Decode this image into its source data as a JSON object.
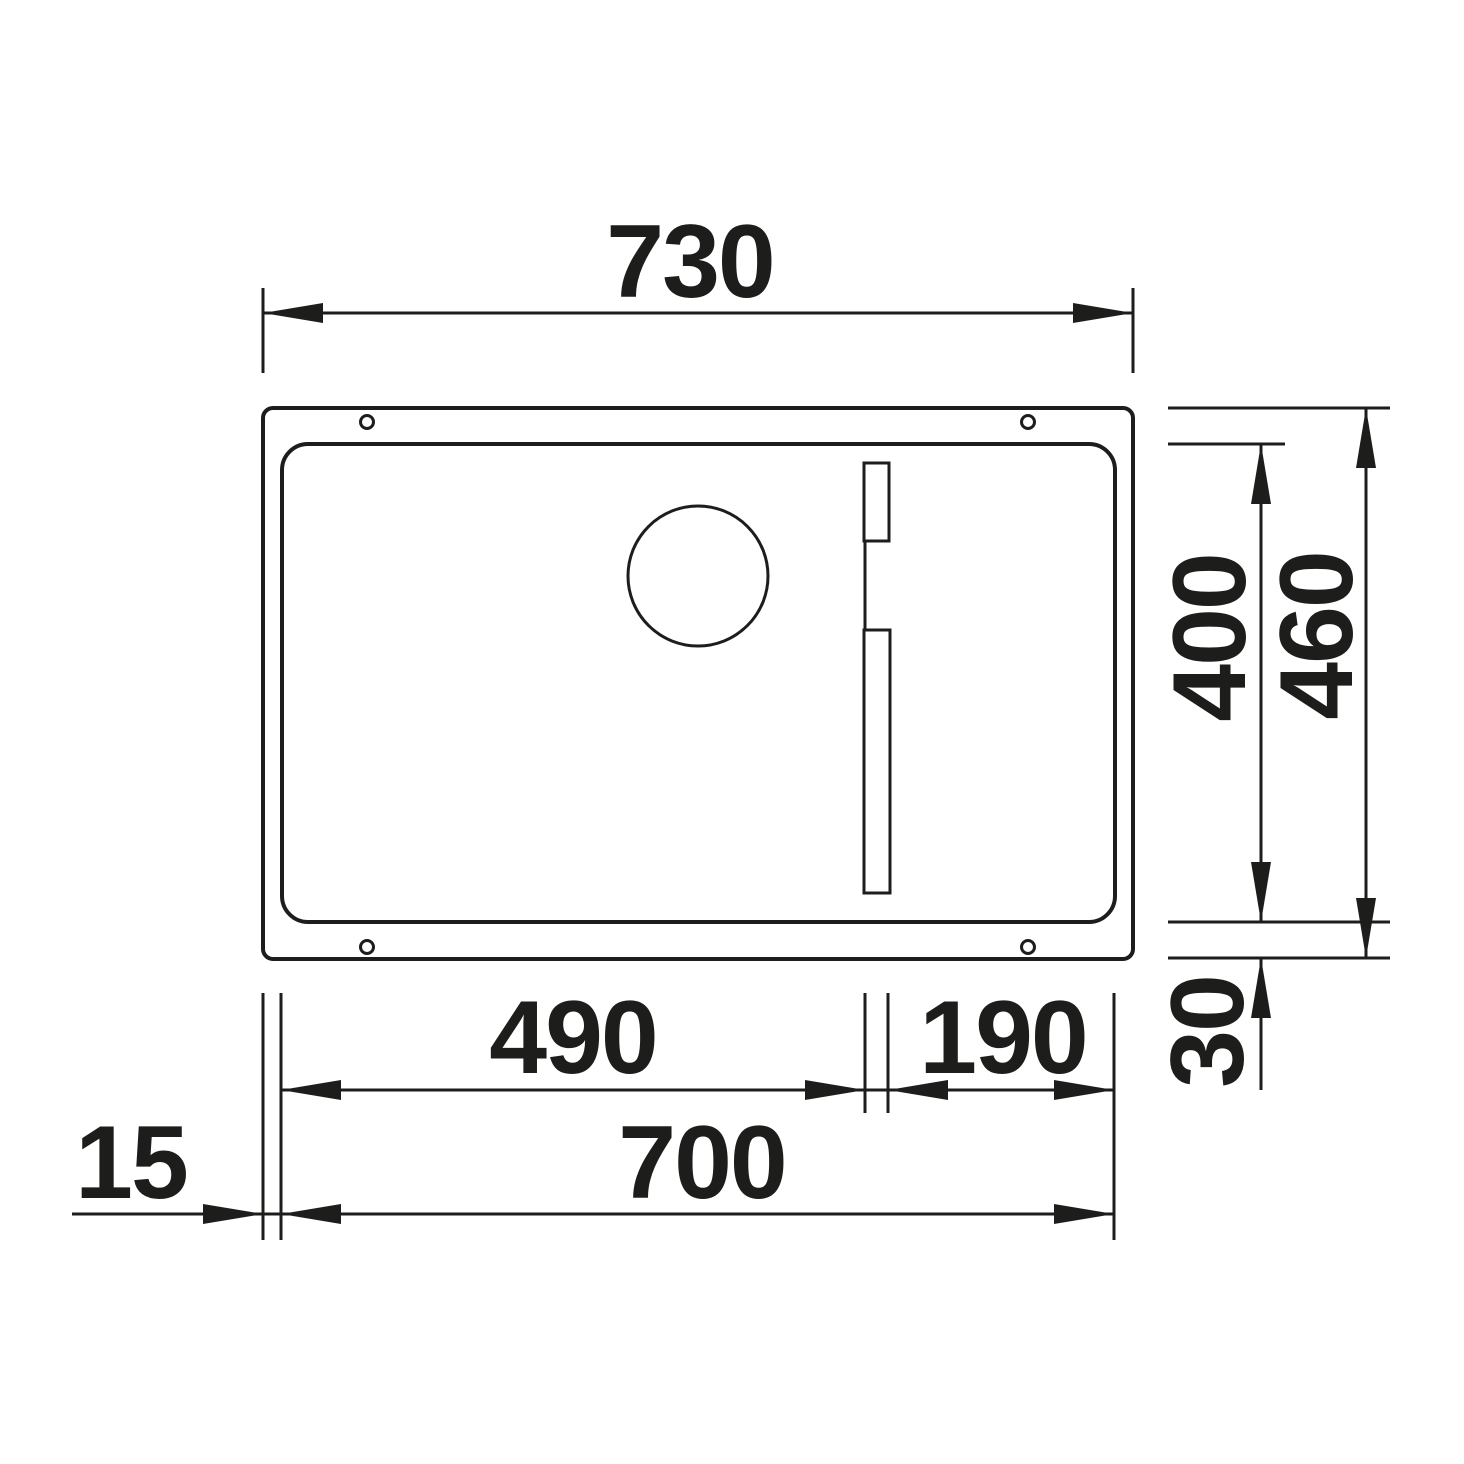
{
  "drawing": {
    "subject": "sink-top-view-technical-drawing",
    "background_color": "#ffffff",
    "line_color": "#1d1d1b"
  },
  "dimensions": {
    "overall_width": "730",
    "bowl_depth": "400",
    "overall_depth": "460",
    "front_rim_offset": "30",
    "bowl_width": "490",
    "rail_section_width": "190",
    "inner_width": "700",
    "side_offset": "15"
  }
}
